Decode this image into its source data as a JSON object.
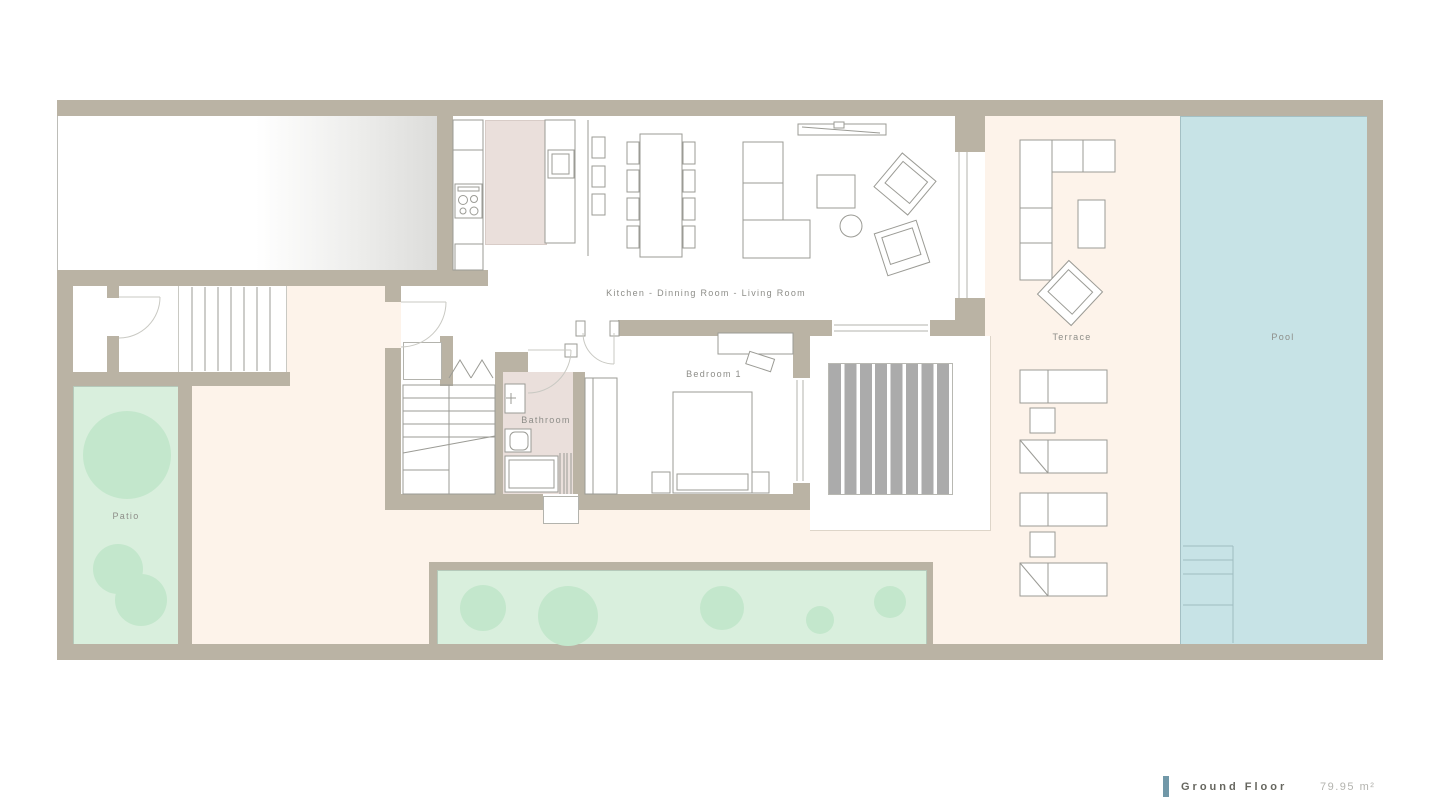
{
  "plan": {
    "rooms": {
      "kitchen_living": "Kitchen - Dinning Room - Living Room",
      "bedroom": "Bedroom 1",
      "bathroom": "Bathroom",
      "patio": "Patio",
      "terrace": "Terrace",
      "pool": "Pool"
    },
    "legend": {
      "title": "Ground Floor",
      "area": "79.95 m²"
    },
    "colors": {
      "wall": "#bab3a4",
      "outdoor": "#fdf3ea",
      "pool_water": "#c7e3e6",
      "patio_grass": "#d9efdd",
      "tree": "#c3e7cc",
      "bath_floor": "#eadfdb",
      "deck_stripe": "#ababab",
      "furniture_line": "#9b9b95",
      "door_arc": "#c9c9c3",
      "label_text": "#8d8d88",
      "legend_accent": "#7198a8",
      "legend_title": "#66665f",
      "legend_area": "#b3b3ae"
    }
  }
}
